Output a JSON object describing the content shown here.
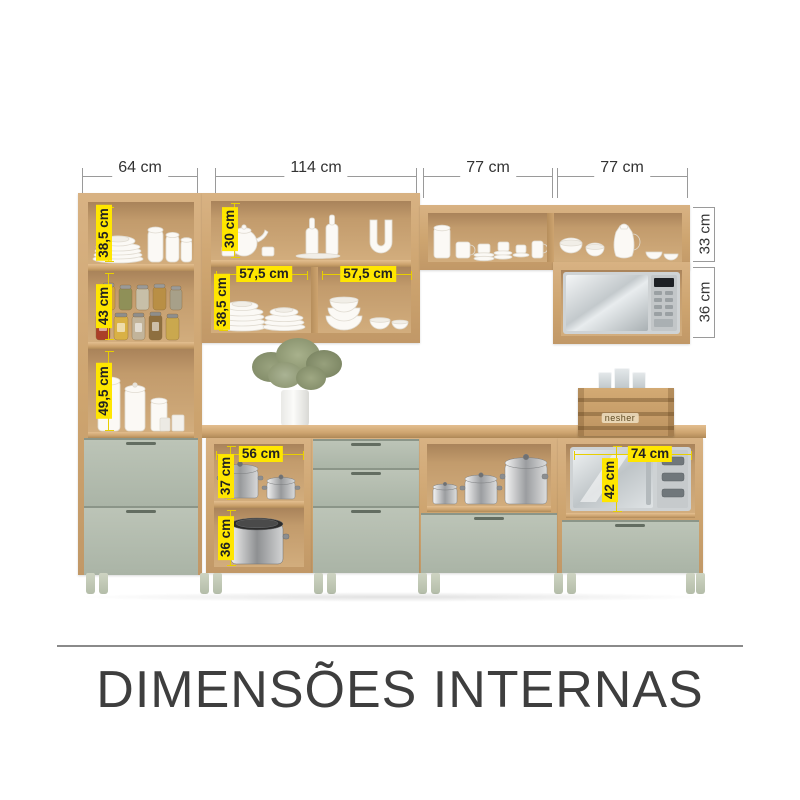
{
  "title": "DIMENSÕES INTERNAS",
  "colors": {
    "wood": "#cda46f",
    "wood_light": "#e3be8f",
    "wood_dark": "#b08a58",
    "drawer_sage": "#aab4a6",
    "highlight_yellow": "#ffe600",
    "dimension_line_gray": "#9a9a9a",
    "text_dark": "#3e3e3e",
    "leg_green": "#c4cbb8"
  },
  "top_dimensions": {
    "left_cabinet_width": "64 cm",
    "mid_cabinet_width": "114 cm",
    "right_cabinet_1_width": "77 cm",
    "right_cabinet_2_width": "77 cm"
  },
  "left_cabinet": {
    "shelf_1_height": "38,5 cm",
    "shelf_2_height": "43 cm",
    "shelf_3_height": "49,5 cm"
  },
  "mid_upper_cabinet": {
    "top_shelf_height": "30 cm",
    "left_compartment_width": "57,5 cm",
    "right_compartment_width": "57,5 cm",
    "lower_shelf_height": "38,5 cm"
  },
  "right_upper_cabinet": {
    "shelf_height": "33 cm",
    "microwave_niche_height": "36 cm"
  },
  "base_open_shelf": {
    "width": "56 cm",
    "upper_height": "37 cm",
    "lower_height": "36 cm"
  },
  "base_microwave_niche": {
    "width": "74 cm",
    "height": "42 cm"
  },
  "crate": {
    "brand": "nesher"
  }
}
